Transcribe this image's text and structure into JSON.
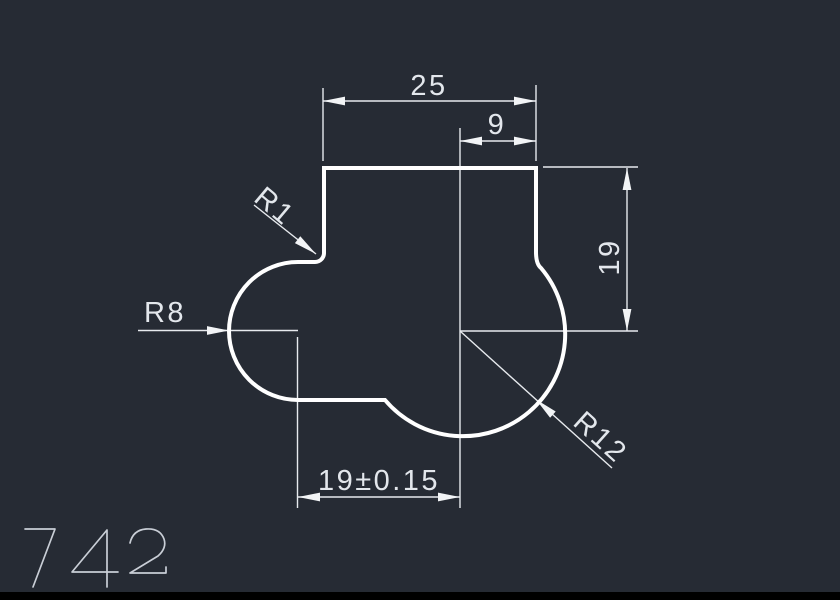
{
  "drawing": {
    "part_number": "742",
    "dimensions": {
      "top_width": "25",
      "top_offset": "9",
      "right_height": "19",
      "bottom_width": "19±0.15",
      "fillet_radius": "R1",
      "left_radius": "R8",
      "right_radius": "R12"
    },
    "colors": {
      "background": "#262b34",
      "outline": "#ffffff",
      "annotation": "#e7eaee",
      "part_number_color": "#c9ced6",
      "footer_bar": "#000000"
    }
  }
}
